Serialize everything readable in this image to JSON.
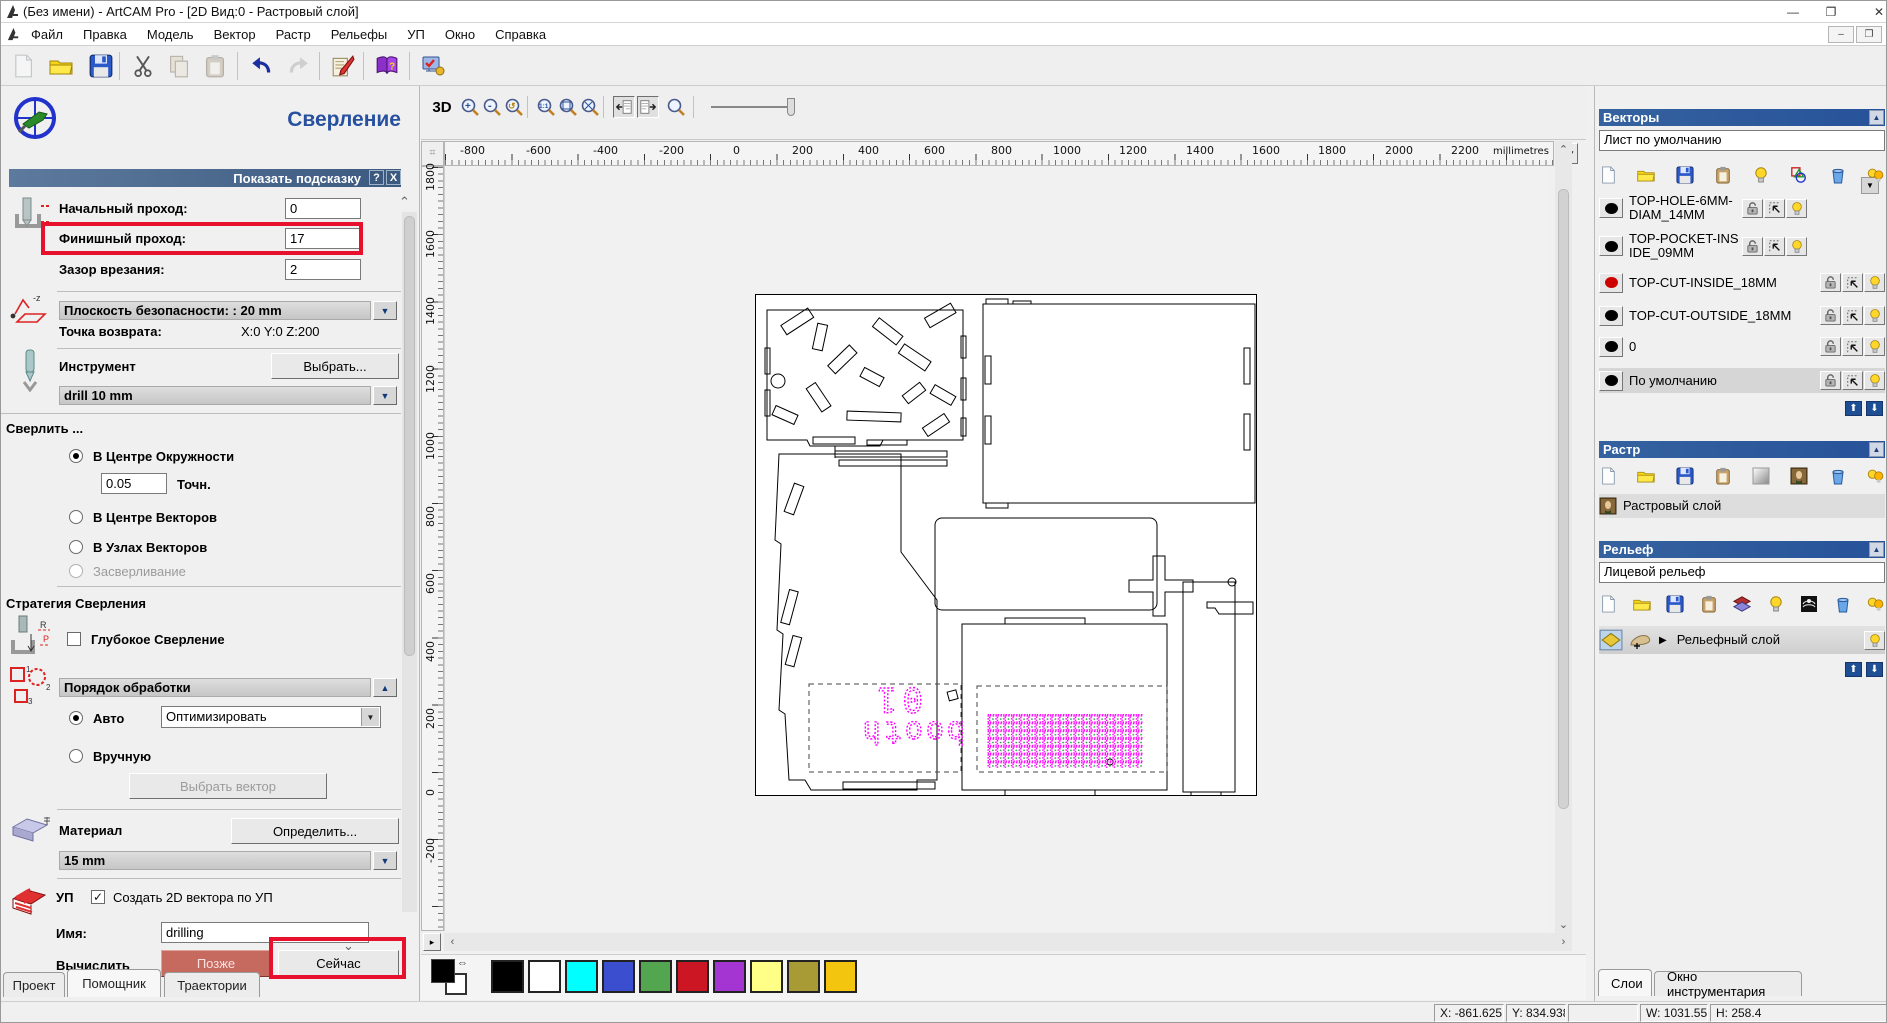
{
  "window": {
    "title": "(Без имени) - ArtCAM Pro - [2D Вид:0 - Растровый слой]",
    "minimize": "—",
    "restore": "❐",
    "close": "✕"
  },
  "menu": {
    "items": [
      "Файл",
      "Правка",
      "Модель",
      "Вектор",
      "Растр",
      "Рельефы",
      "УП",
      "Окно",
      "Справка"
    ]
  },
  "toolbar": {
    "icons": [
      "new-file",
      "open-file",
      "save-file",
      "cut",
      "copy",
      "paste",
      "undo",
      "redo",
      "toolpath-editor",
      "help-book",
      "options-wizard"
    ]
  },
  "assistant": {
    "title": "Сверление",
    "tip_bar": "Показать подсказку",
    "tip_help": "?",
    "tip_close": "X",
    "start_pass_label": "Начальный проход:",
    "start_pass_value": "0",
    "finish_pass_label": "Финишный проход:",
    "finish_pass_value": "17",
    "plunge_label": "Зазор врезания:",
    "plunge_value": "2",
    "safe_plane": "Плоскость безопасности: : 20 mm",
    "return_label": "Точка возврата:",
    "return_value": "X:0 Y:0 Z:200",
    "tool_label": "Инструмент",
    "tool_select": "Выбрать...",
    "tool_name": "drill 10 mm",
    "drill_header": "Сверлить ...",
    "radio_circle": "В Центре Окружности",
    "tol_value": "0.05",
    "tol_label": "Точн.",
    "radio_centers": "В Центре Векторов",
    "radio_nodes": "В Узлах Векторов",
    "radio_spot": "Засверливание",
    "strategy_header": "Стратегия Сверления",
    "deep_drill": "Глубокое Сверление",
    "order_header": "Порядок обработки",
    "radio_auto": "Авто",
    "order_combo": "Оптимизировать",
    "radio_manual": "Вручную",
    "select_vector": "Выбрать вектор",
    "material_label": "Материал",
    "material_define": "Определить...",
    "material_value": "15 mm",
    "nc_label": "УП",
    "create2d_label": "Создать 2D вектора по УП",
    "name_label": "Имя:",
    "name_value": "drilling",
    "calc_label": "Вычислить",
    "later": "Позже",
    "now": "Сейчас"
  },
  "tabs_left": {
    "project": "Проект",
    "assistant": "Помощник",
    "toolpaths": "Траектории"
  },
  "canvas": {
    "view_toggle": "3D",
    "units": "millimetres",
    "h_labels": [
      "-800",
      "-600",
      "-400",
      "-200",
      "0",
      "200",
      "400",
      "600",
      "800",
      "1000",
      "1200",
      "1400",
      "1600",
      "1800",
      "2000",
      "2200"
    ],
    "v_labels": [
      "1800",
      "1600",
      "1400",
      "1200",
      "1000",
      "800",
      "600",
      "400",
      "200",
      "0",
      "-200"
    ],
    "drawing_text": {
      "line1": "01",
      "line2": "booth"
    }
  },
  "palette": {
    "colors": [
      "#000000",
      "#ffffff",
      "#00ffff",
      "#3c4ed0",
      "#53a64f",
      "#cd1623",
      "#a435d2",
      "#ffff87",
      "#a89b35",
      "#f3c50f"
    ],
    "primary": "#000000",
    "secondary": "#ffffff"
  },
  "vectors_panel": {
    "header": "Векторы",
    "sheet_combo": "Лист по умолчанию",
    "icons": [
      "new-sheet",
      "open",
      "save",
      "paste",
      "show-layer",
      "shapes",
      "delete",
      "all-layers-visible"
    ],
    "layers": [
      {
        "name": "TOP-HOLE-6MM-DIAM_14MM",
        "color": "#000000"
      },
      {
        "name": "TOP-POCKET-INSIDE_09MM",
        "color": "#000000"
      },
      {
        "name": "TOP-CUT-INSIDE_18MM",
        "color": "#cc0000"
      },
      {
        "name": "TOP-CUT-OUTSIDE_18MM",
        "color": "#000000"
      },
      {
        "name": "0",
        "color": "#000000"
      },
      {
        "name": "По умолчанию",
        "color": "#000000"
      }
    ]
  },
  "raster_panel": {
    "header": "Растр",
    "icons": [
      "new-layer",
      "open",
      "save",
      "paste",
      "clear-layer",
      "copy-image",
      "delete",
      "all-layers-visible"
    ],
    "layer": "Растровый слой"
  },
  "relief_panel": {
    "header": "Рельеф",
    "side_combo": "Лицевой рельеф",
    "icons": [
      "new-layer",
      "open",
      "save",
      "paste",
      "merge-stack",
      "show-layer",
      "stamp",
      "delete",
      "all-layers-visible"
    ],
    "layer": "Рельефный слой"
  },
  "tabs_right": {
    "layers": "Слои",
    "toolbox": "Окно инструментария"
  },
  "status": {
    "x": "X: -861.625",
    "y": "Y: 834.938",
    "w": "W: 1031.556",
    "h": "H: 258.4"
  },
  "colors": {
    "header_blue": "#2d5c9e",
    "tipbar_blue": "#3c5a80",
    "highlight_red": "#e8112d",
    "vector_magenta": "#ff00ff",
    "later_btn": "#c66a60"
  }
}
